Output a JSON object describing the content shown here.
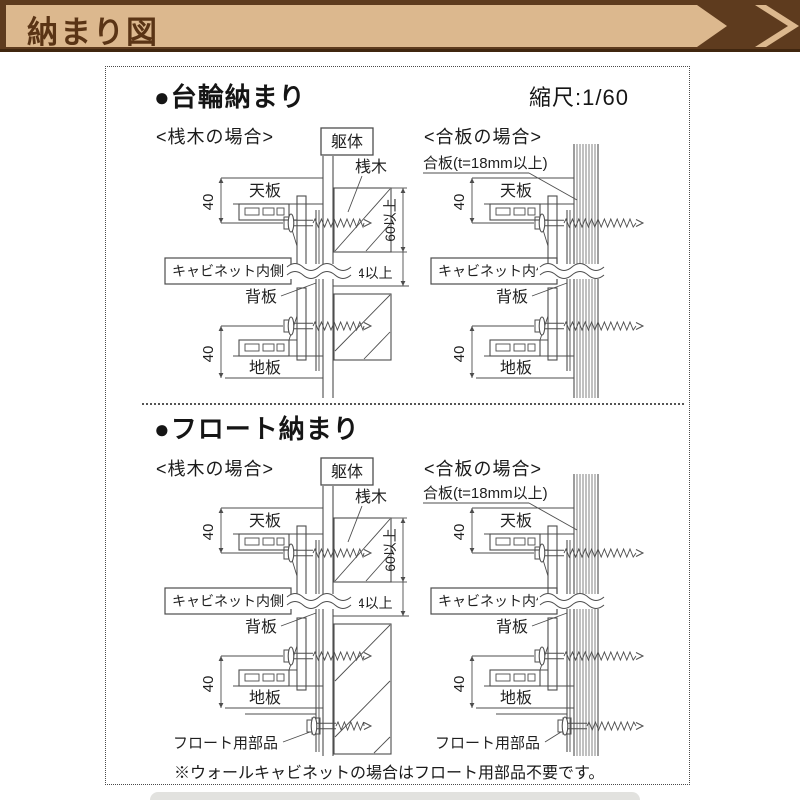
{
  "header": {
    "title": "納まり図"
  },
  "sheet": {
    "sections": [
      {
        "heading": "●台輪納まり",
        "scale": "縮尺:1/60"
      },
      {
        "heading": "●フロート納まり"
      }
    ],
    "labels": {
      "case_batten": "<桟木の場合>",
      "case_plywood": "<合板の場合>",
      "frame": "躯体",
      "batten": "桟木",
      "plywood": "合板(t=18mm以上)",
      "top_panel": "天板",
      "bottom_panel": "地板",
      "back_panel": "背板",
      "cabinet_inside": "キャビネット内側",
      "dim_40": "40",
      "dim_60_min": "60以上",
      "dim_24_min": "24以上",
      "float_part": "フロート用部品"
    },
    "note": "※ウォールキャビネットの場合はフロート用部品不要です。"
  },
  "colors": {
    "banner_tan": "#dcb88e",
    "banner_brown": "#5e3b1e",
    "banner_text": "#5a3415",
    "line": "#4d4d4d"
  }
}
